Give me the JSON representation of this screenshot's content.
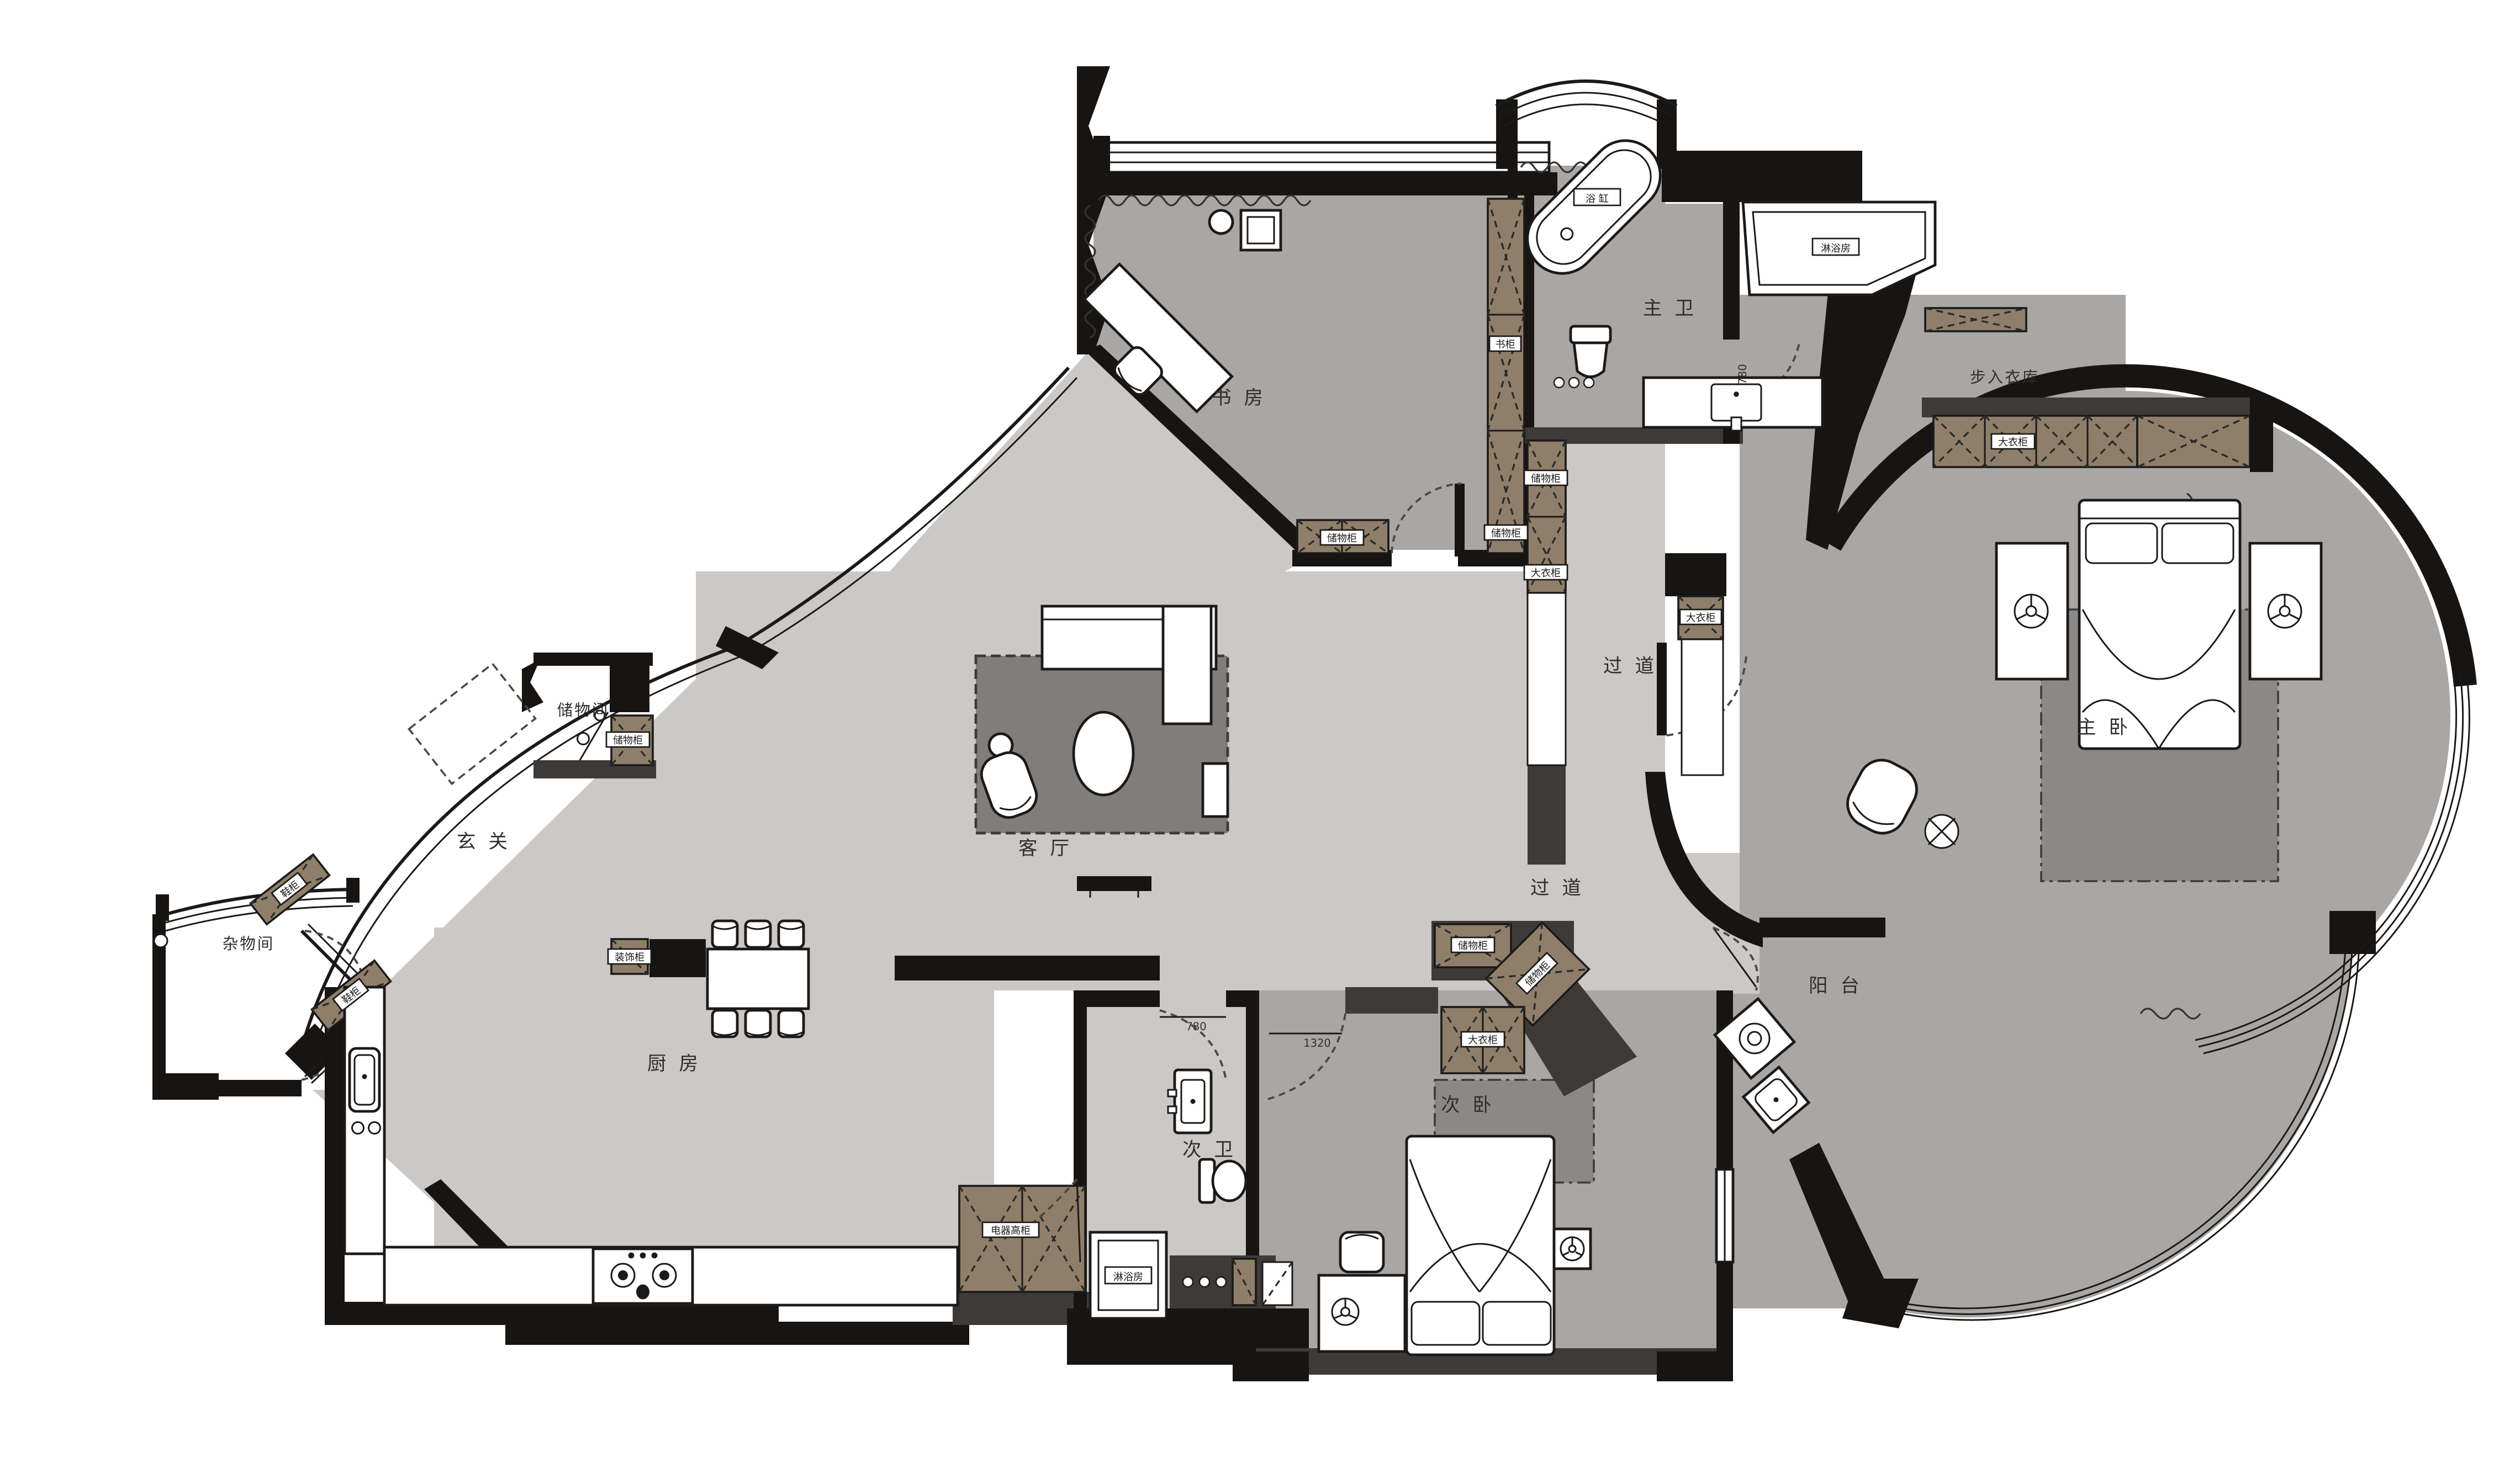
{
  "plan_title": "apartment-floor-plan",
  "colors": {
    "background": "#ffffff",
    "wall_black": "#161514",
    "wall_dark_gray": "#3c3b39",
    "floor_light_gray": "#cac9c7",
    "floor_mid_gray": "#a8a7a5",
    "rug_dark_gray": "#7f7e7c",
    "cabinet_brown": "#8e7e6a",
    "fixture_white": "#ffffff"
  },
  "rooms": {
    "study": {
      "label": "书 房"
    },
    "master_bath": {
      "label": "主 卫"
    },
    "walk_in_closet": {
      "label": "步入衣库"
    },
    "master_bedroom": {
      "label": "主 卧"
    },
    "corridor_upper": {
      "label": "过 道"
    },
    "corridor_lower": {
      "label": "过 道"
    },
    "living_room": {
      "label": "客 厅"
    },
    "foyer": {
      "label": "玄 关"
    },
    "storage_room": {
      "label": "储物间"
    },
    "utility_room": {
      "label": "杂物间"
    },
    "kitchen": {
      "label": "厨 房"
    },
    "second_bath": {
      "label": "次 卫"
    },
    "second_bedroom": {
      "label": "次 卧"
    },
    "balcony": {
      "label": "阳 台"
    }
  },
  "fixtures": {
    "bathtub": {
      "label": "浴 缸"
    },
    "shower_master": {
      "label": "淋浴房"
    },
    "shower_second": {
      "label": "淋浴房"
    }
  },
  "cabinets": {
    "bookcase_study": {
      "label": "书柜"
    },
    "storage_study_wall": {
      "label": "储物柜"
    },
    "storage_corridor": {
      "label": "储物柜"
    },
    "wardrobe_corridor": {
      "label": "大衣柜"
    },
    "storage_study_bottom": {
      "label": "储物柜"
    },
    "wardrobe_closet": {
      "label": "大衣柜"
    },
    "wardrobe_entry": {
      "label": "大衣柜"
    },
    "storage_storageroom": {
      "label": "储物柜"
    },
    "shoe_upper": {
      "label": "鞋柜"
    },
    "shoe_lower": {
      "label": "鞋柜"
    },
    "deco_hall": {
      "label": "装饰柜"
    },
    "appliance_kitchen": {
      "label": "电器高柜"
    },
    "storage_bed2_h": {
      "label": "储物柜"
    },
    "storage_bed2_diag": {
      "label": "储物柜"
    },
    "wardrobe_bed2": {
      "label": "大衣柜"
    }
  },
  "dimensions": {
    "door_master_bath": "780",
    "door_second_bath": "780",
    "door_second_bedroom": "1320"
  }
}
